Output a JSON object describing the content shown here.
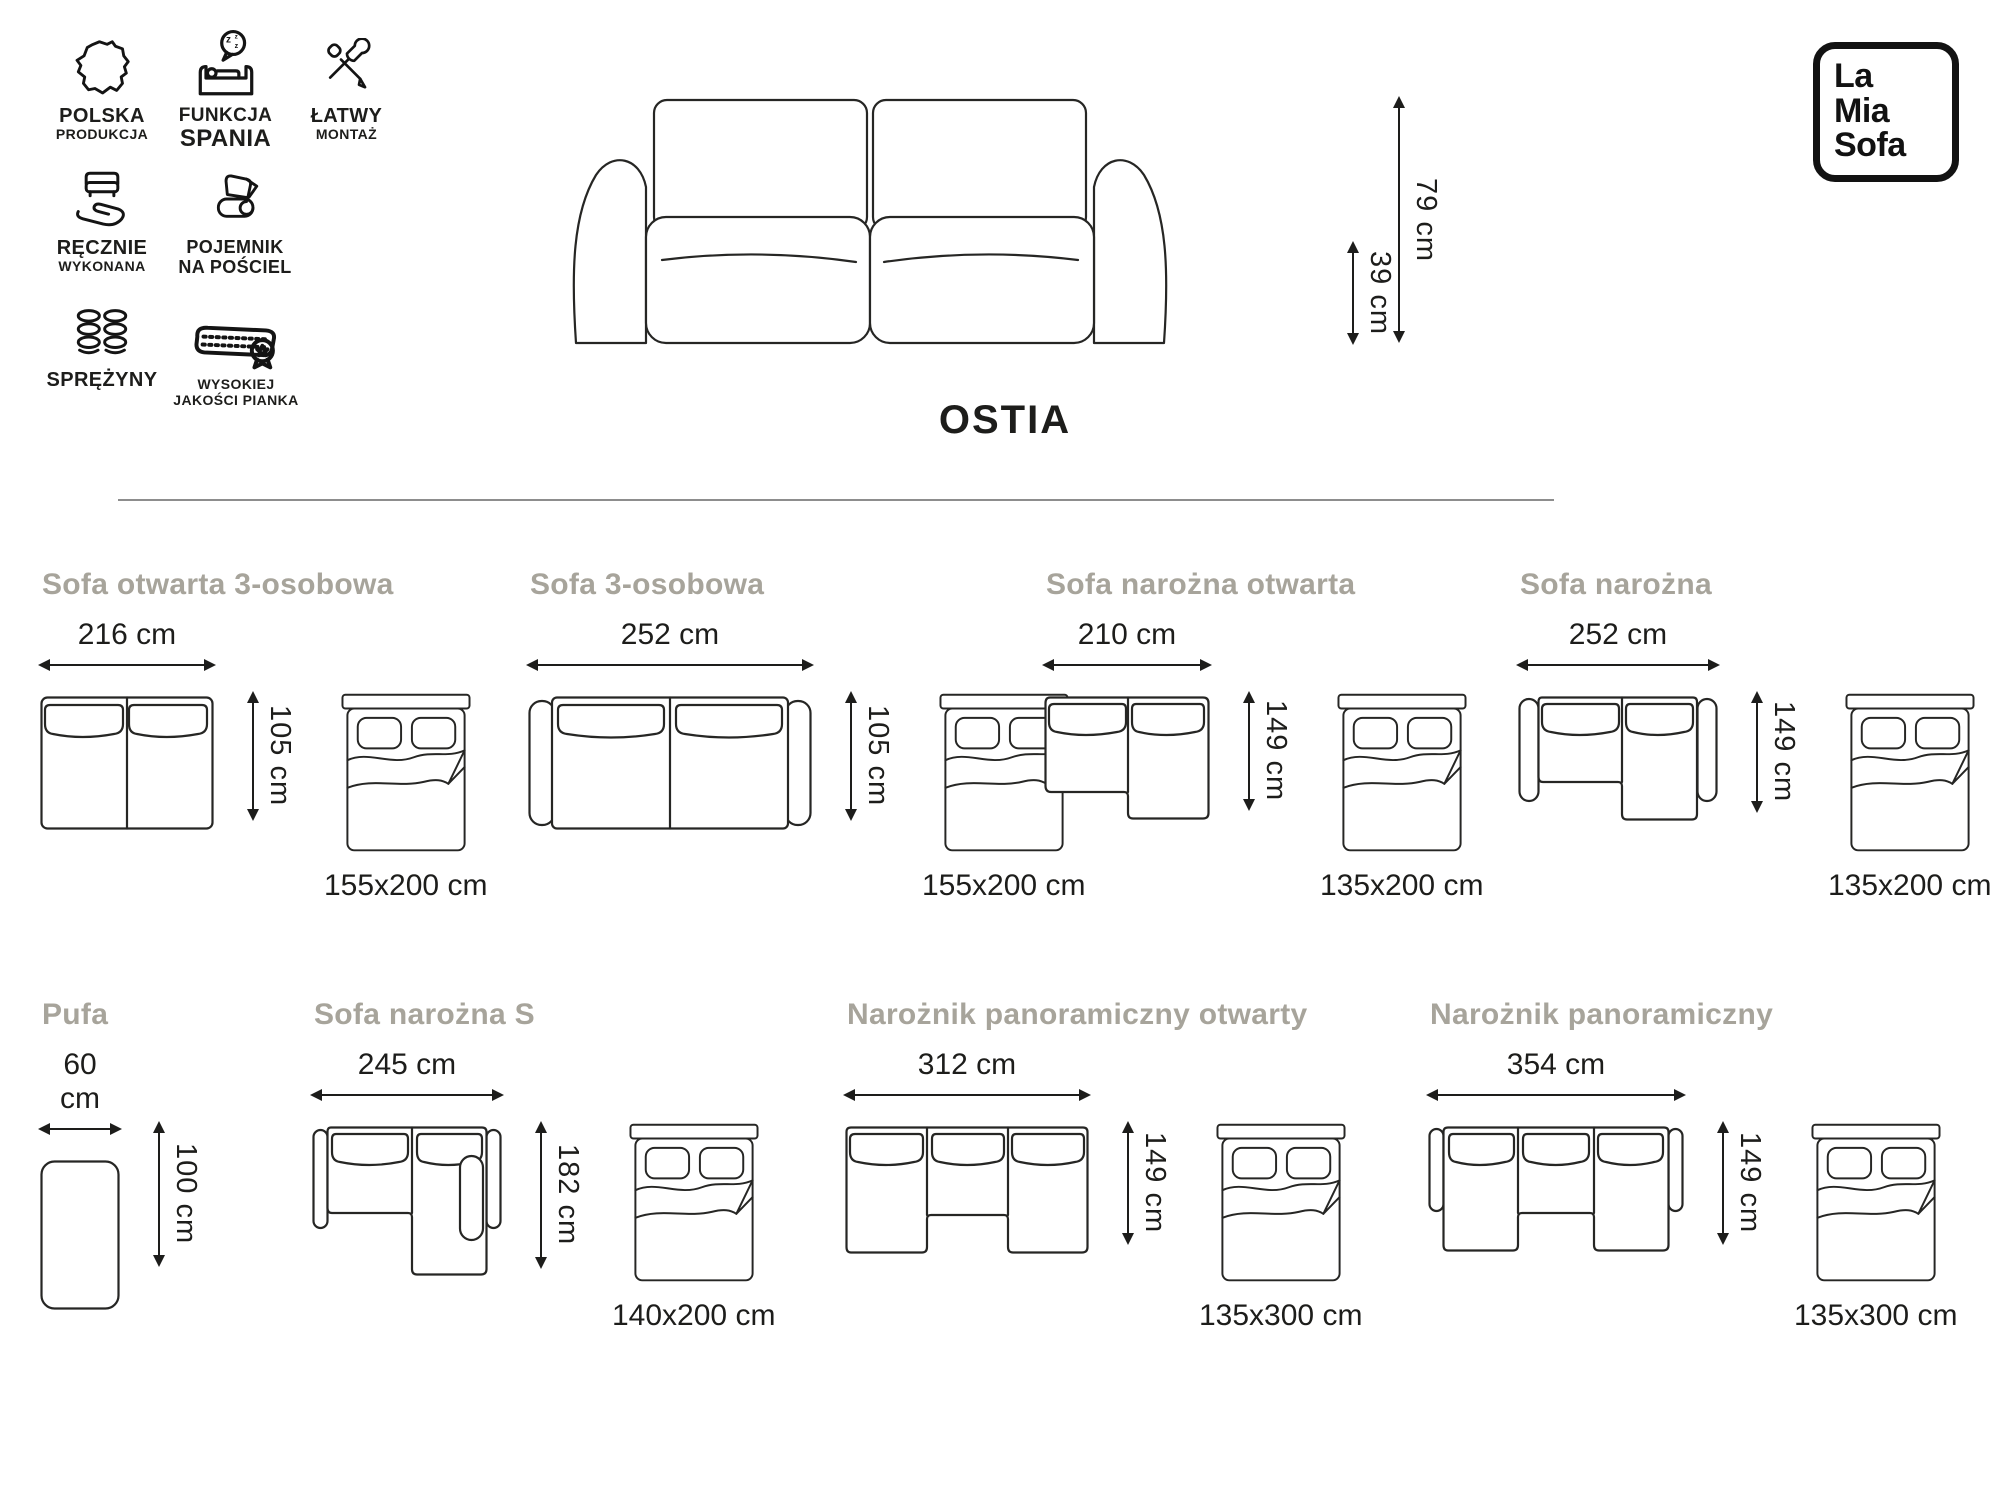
{
  "brand": {
    "logo_lines": [
      "La",
      "Mia",
      "Sofa"
    ]
  },
  "product": {
    "title": "OSTIA",
    "back_height": "79 cm",
    "seat_height": "39 cm"
  },
  "features": [
    {
      "icon": "poland-map-icon",
      "line1": "POLSKA",
      "line2": "PRODUKCJA"
    },
    {
      "icon": "sleep-function-icon",
      "line1": "FUNKCJA",
      "line2": "SPANIA"
    },
    {
      "icon": "tools-icon",
      "line1": "ŁATWY",
      "line2": "MONTAŻ"
    },
    {
      "icon": "hand-sofa-icon",
      "line1": "RĘCZNIE",
      "line2": "WYKONANA"
    },
    {
      "icon": "bedding-icon",
      "line1": "POJEMNIK",
      "line2": "NA POŚCIEL"
    },
    {
      "icon": "springs-icon",
      "line1": "SPRĘŻYNY",
      "line2": ""
    },
    {
      "icon": "foam-icon",
      "line1": "WYSOKIEJ",
      "line2": "JAKOŚCI PIANKA"
    }
  ],
  "variants": [
    {
      "name": "Sofa otwarta 3-osobowa",
      "width": "216 cm",
      "depth": "105 cm",
      "bed": "155x200 cm"
    },
    {
      "name": "Sofa 3-osobowa",
      "width": "252 cm",
      "depth": "105 cm",
      "bed": "155x200 cm"
    },
    {
      "name": "Sofa narożna otwarta",
      "width": "210 cm",
      "depth": "149 cm",
      "bed": "135x200 cm"
    },
    {
      "name": "Sofa narożna",
      "width": "252 cm",
      "depth": "149 cm",
      "bed": "135x200 cm"
    },
    {
      "name": "Pufa",
      "width": "60 cm",
      "depth": "100 cm"
    },
    {
      "name": "Sofa narożna S",
      "width": "245 cm",
      "depth": "182 cm",
      "bed": "140x200 cm"
    },
    {
      "name": "Narożnik panoramiczny otwarty",
      "width": "312 cm",
      "depth": "149 cm",
      "bed": "135x300 cm"
    },
    {
      "name": "Narożnik panoramiczny",
      "width": "354 cm",
      "depth": "149 cm",
      "bed": "135x300 cm"
    }
  ],
  "colors": {
    "ink": "#1d1d1b",
    "muted_title": "#a7a49b",
    "divider": "#8d8d8d"
  }
}
